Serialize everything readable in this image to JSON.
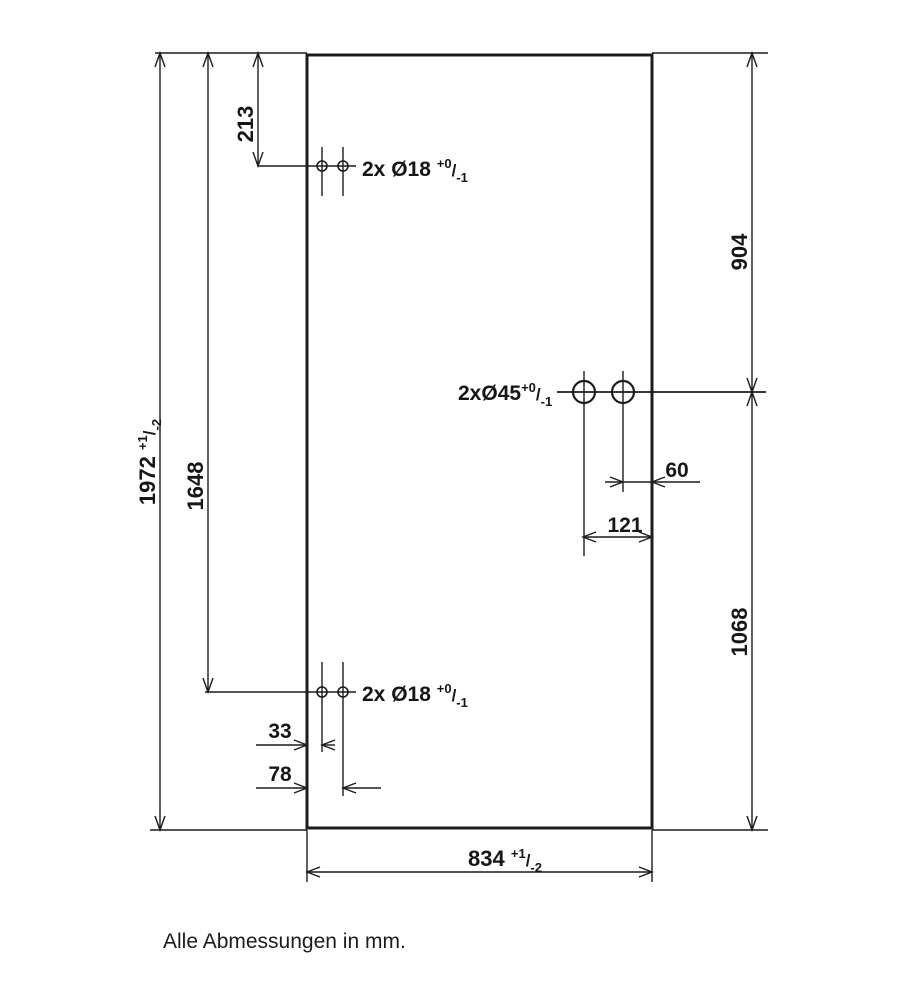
{
  "drawing": {
    "type": "glass-panel-dimension-drawing",
    "footer_note": "Alle Abmessungen in mm.",
    "colors": {
      "line": "#1c1c1c",
      "text": "#161616",
      "background": "#ffffff"
    },
    "dims": {
      "total_height": {
        "value": "1972",
        "tol_plus": "+1",
        "tol_sep": "/",
        "tol_minus": "-2"
      },
      "bottom_holes_height": {
        "value": "1648"
      },
      "top_holes_offset": {
        "value": "213"
      },
      "right_upper": {
        "value": "904"
      },
      "right_lower": {
        "value": "1068"
      },
      "mid_hole_offset_small": {
        "value": "60"
      },
      "mid_hole_offset_large": {
        "value": "121"
      },
      "bottom_hole_offset_small": {
        "value": "33"
      },
      "bottom_hole_offset_large": {
        "value": "78"
      },
      "total_width": {
        "value": "834",
        "tol_plus": "+1",
        "tol_sep": "/",
        "tol_minus": "-2"
      }
    },
    "hole_labels": {
      "top": {
        "text": "2x Ø18 ",
        "tol_plus": "+0",
        "tol_sep": "/",
        "tol_minus": "-1"
      },
      "middle": {
        "text": "2xØ45",
        "tol_plus": "+0",
        "tol_sep": "/",
        "tol_minus": "-1"
      },
      "bottom": {
        "text": "2x Ø18 ",
        "tol_plus": "+0",
        "tol_sep": "/",
        "tol_minus": "-1"
      }
    }
  }
}
